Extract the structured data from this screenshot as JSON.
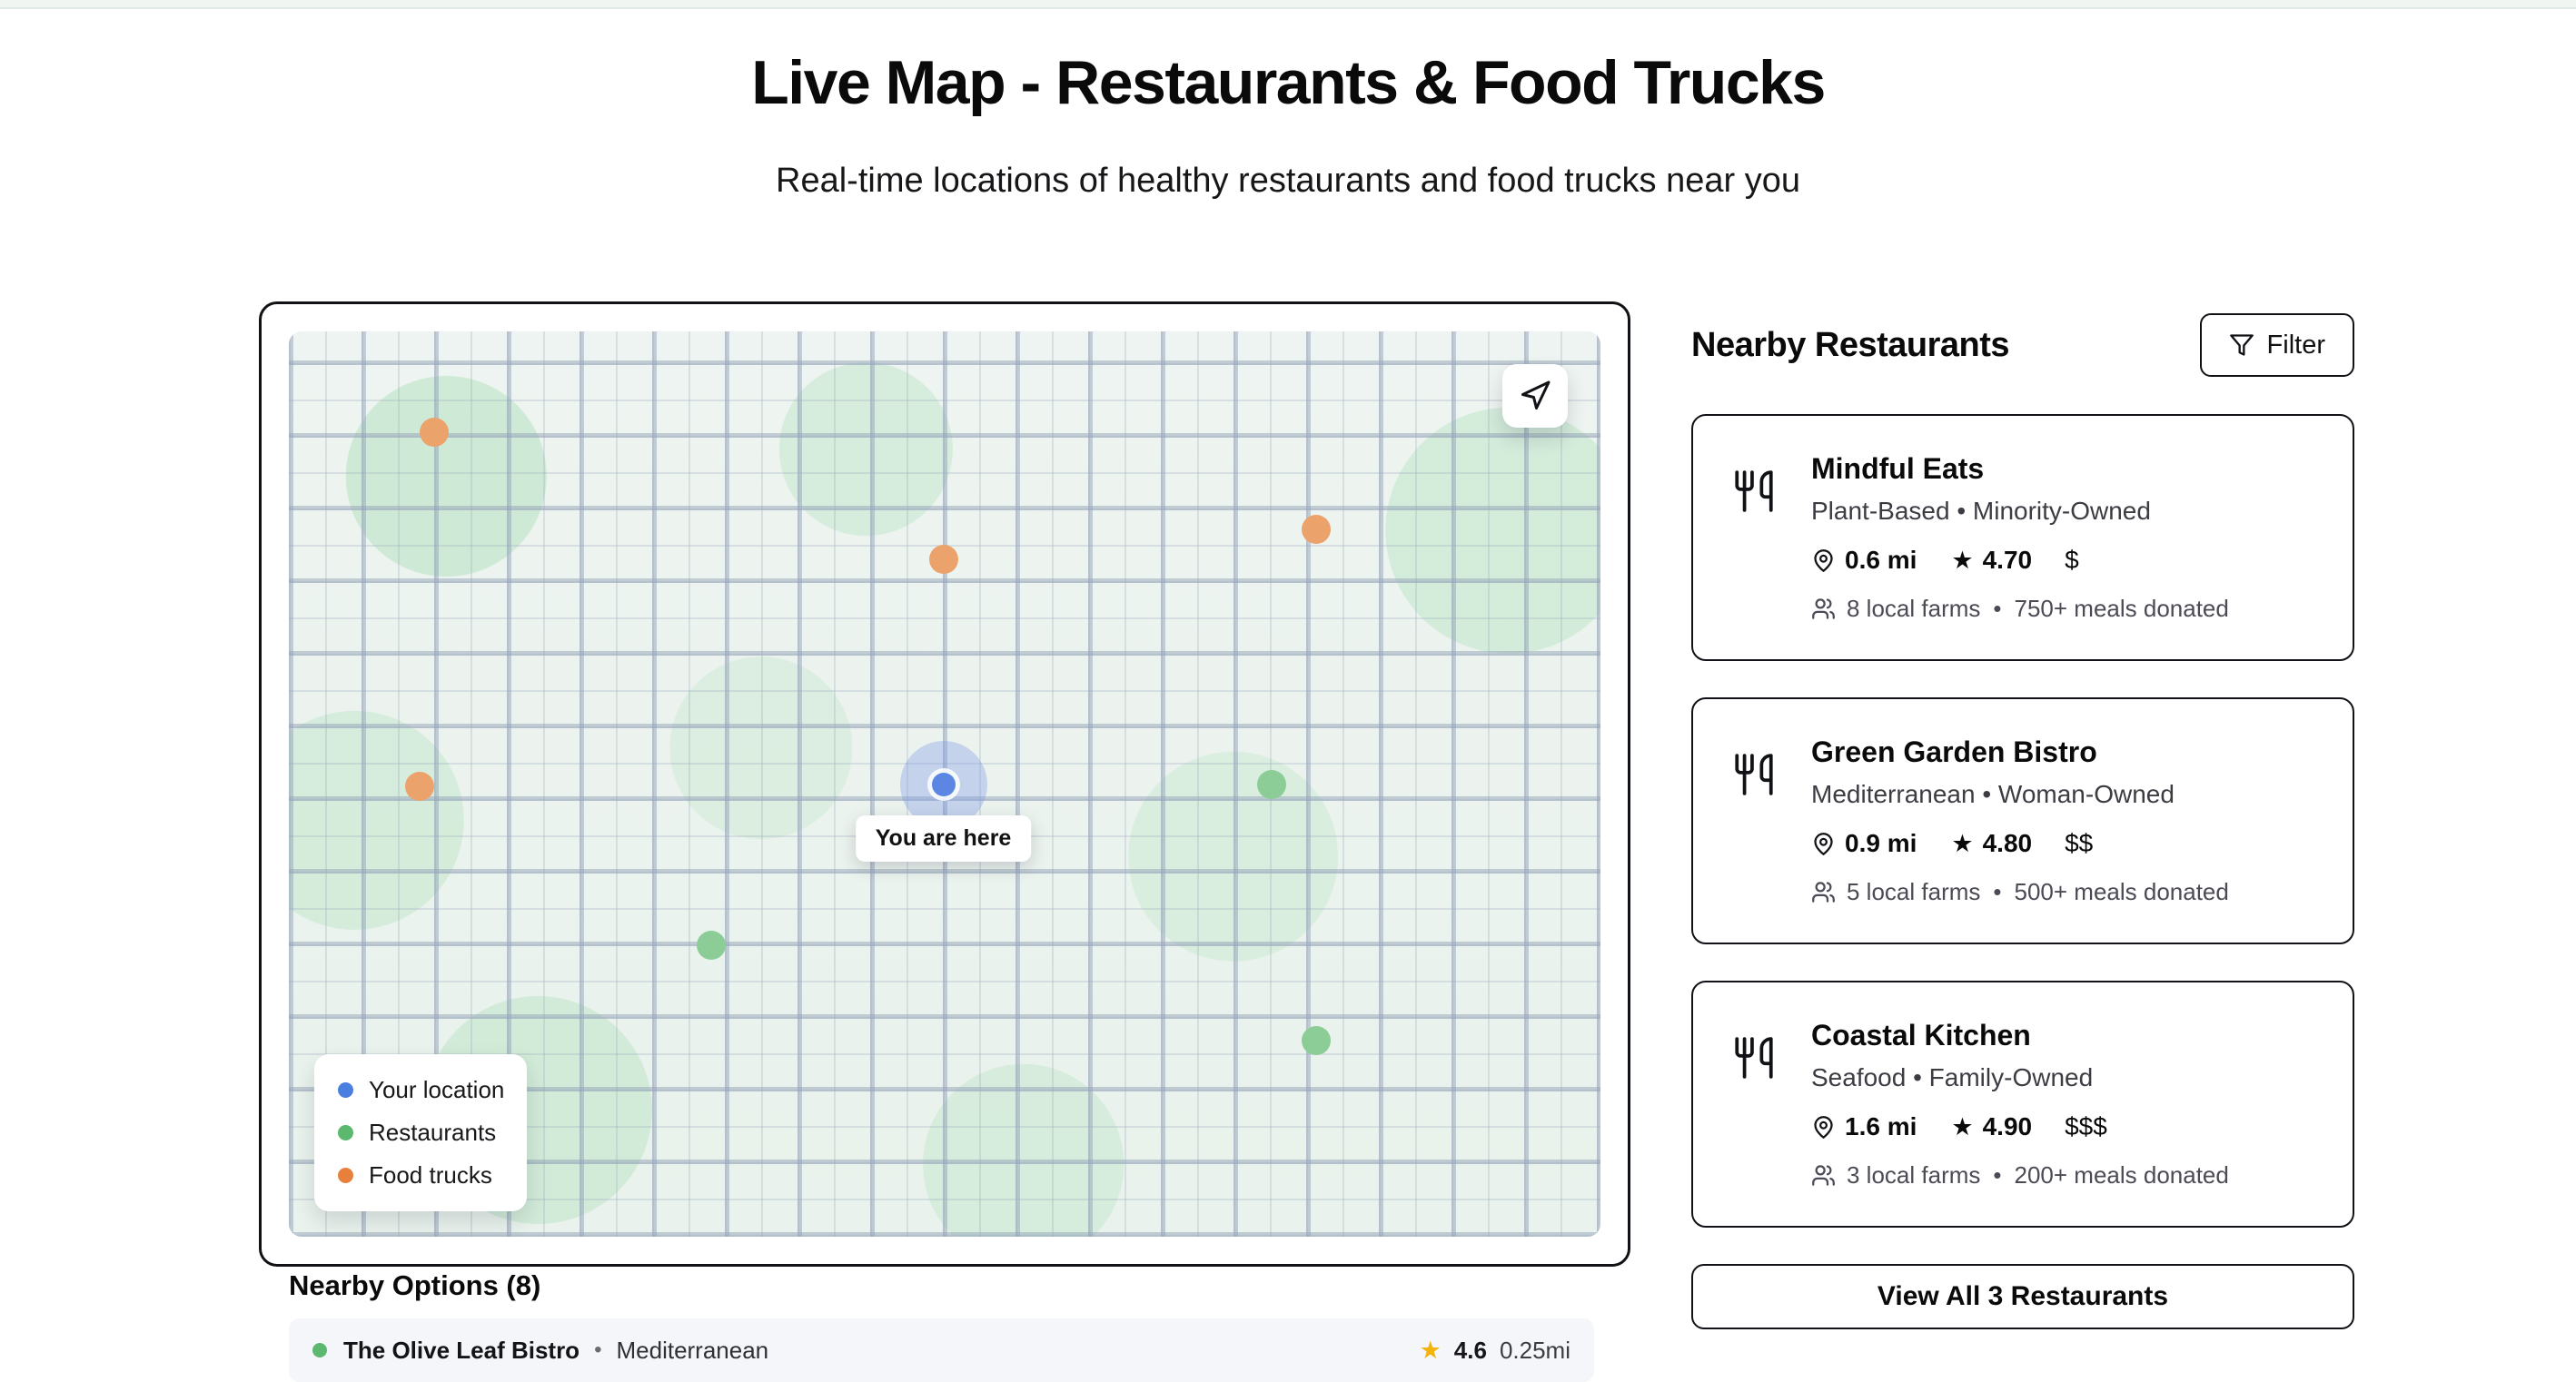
{
  "ui": {
    "bullet": "•",
    "star": "★"
  },
  "colors": {
    "user_blue": "#4a7fe0",
    "restaurant_green": "#5cb86e",
    "food_truck_orange": "#e8803d",
    "map_marker_green": "#8ccd97",
    "map_marker_orange": "#eca26b",
    "star_gold": "#f3b20c"
  },
  "header": {
    "title": "Live Map - Restaurants & Food Trucks",
    "subtitle": "Real-time locations of healthy restaurants and food trucks near you"
  },
  "map": {
    "you_are_here_label": "You are here",
    "legend": [
      {
        "label": "Your location",
        "color": "#4a7fe0"
      },
      {
        "label": "Restaurants",
        "color": "#5cb86e"
      },
      {
        "label": "Food trucks",
        "color": "#e8803d"
      }
    ],
    "marker_colors": {
      "restaurant": "#8ccd97",
      "food-truck": "#eca26b"
    },
    "markers": [
      {
        "type": "food-truck",
        "x": "11.1%",
        "y": "11.1%"
      },
      {
        "type": "food-truck",
        "x": "49.9%",
        "y": "25.2%"
      },
      {
        "type": "food-truck",
        "x": "78.3%",
        "y": "21.9%"
      },
      {
        "type": "food-truck",
        "x": "10.0%",
        "y": "50.3%"
      },
      {
        "type": "restaurant",
        "x": "74.9%",
        "y": "50.1%"
      },
      {
        "type": "restaurant",
        "x": "32.2%",
        "y": "67.8%"
      },
      {
        "type": "restaurant",
        "x": "78.3%",
        "y": "78.3%"
      }
    ]
  },
  "sidebar": {
    "title": "Nearby Restaurants",
    "filter_label": "Filter",
    "view_all_label": "View All 3 Restaurants",
    "restaurants": [
      {
        "name": "Mindful Eats",
        "tags": "Plant-Based • Minority-Owned",
        "distance": "0.6 mi",
        "rating": "4.70",
        "price": "$",
        "farms": "8 local farms",
        "donated": "750+ meals donated"
      },
      {
        "name": "Green Garden Bistro",
        "tags": "Mediterranean • Woman-Owned",
        "distance": "0.9 mi",
        "rating": "4.80",
        "price": "$$",
        "farms": "5 local farms",
        "donated": "500+ meals donated"
      },
      {
        "name": "Coastal Kitchen",
        "tags": "Seafood • Family-Owned",
        "distance": "1.6 mi",
        "rating": "4.90",
        "price": "$$$",
        "farms": "3 local farms",
        "donated": "200+ meals donated"
      }
    ]
  },
  "nearby": {
    "heading": "Nearby Options (8)",
    "items": [
      {
        "name": "The Olive Leaf Bistro",
        "cuisine": "Mediterranean",
        "rating": "4.6",
        "distance": "0.25mi"
      }
    ]
  }
}
